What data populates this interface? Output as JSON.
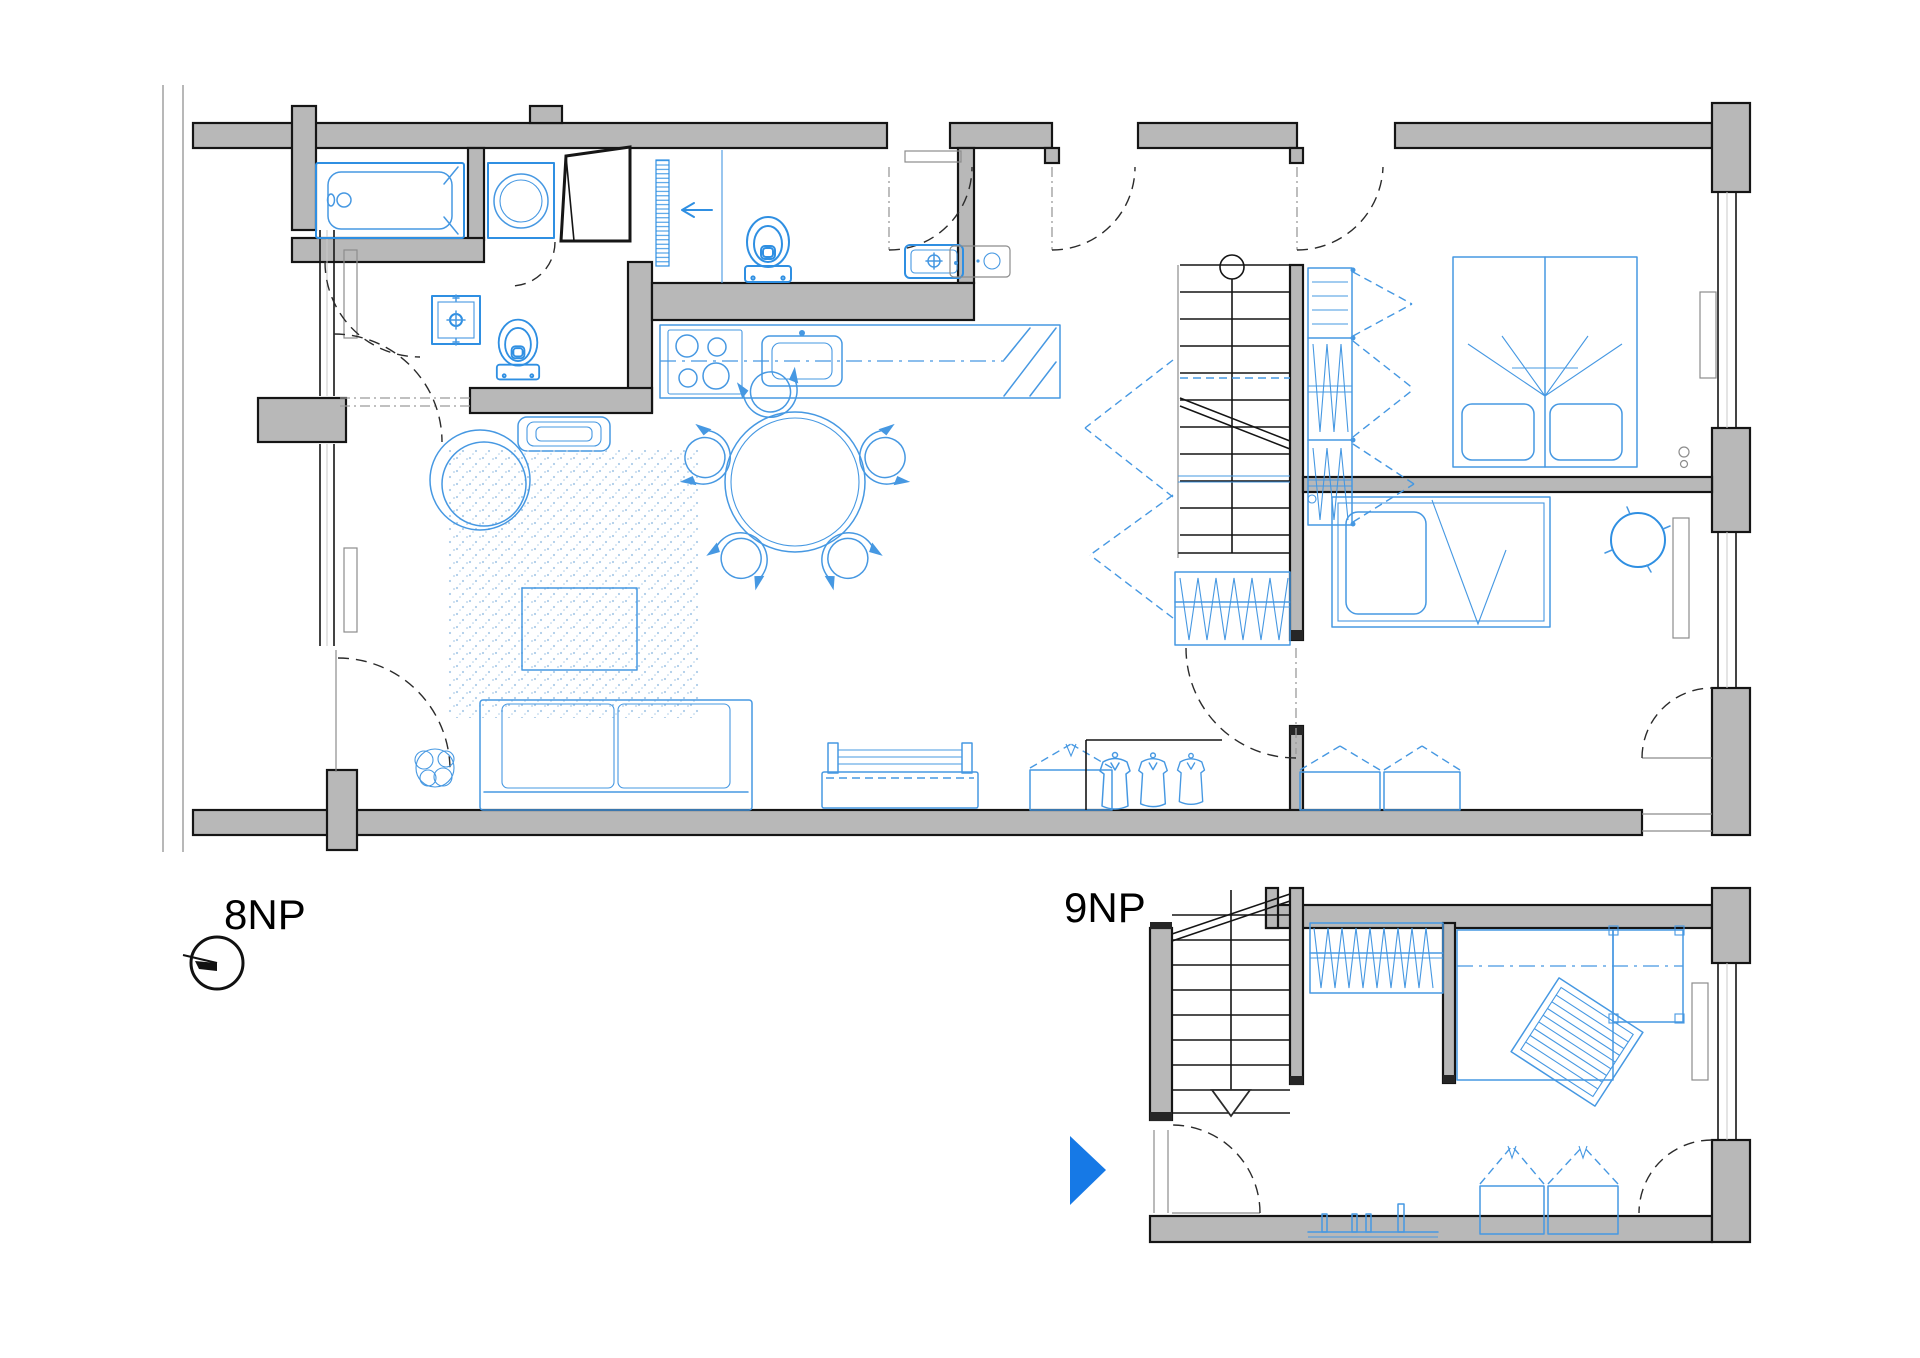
{
  "canvas": {
    "background": "#ffffff",
    "width": 1920,
    "height": 1358
  },
  "floors": [
    {
      "id": "8np",
      "label": "8NP"
    },
    {
      "id": "9np",
      "label": "9NP"
    }
  ],
  "markers": {
    "north_indicator": "north-symbol-circle-with-line",
    "entry_arrow": "blue-right-pointing-triangle"
  },
  "colors": {
    "wall_fill": "#b8b8b8",
    "wall_outline": "#151515",
    "furniture_blue": "#4698e2",
    "fixture_blue": "#2f8fe2",
    "stipple_blue": "#aecde9",
    "accent_arrow_blue": "#1679e6",
    "context_gray": "#9a9a9a",
    "detail_gray": "#8c8c8c",
    "label_black": "#000000"
  }
}
